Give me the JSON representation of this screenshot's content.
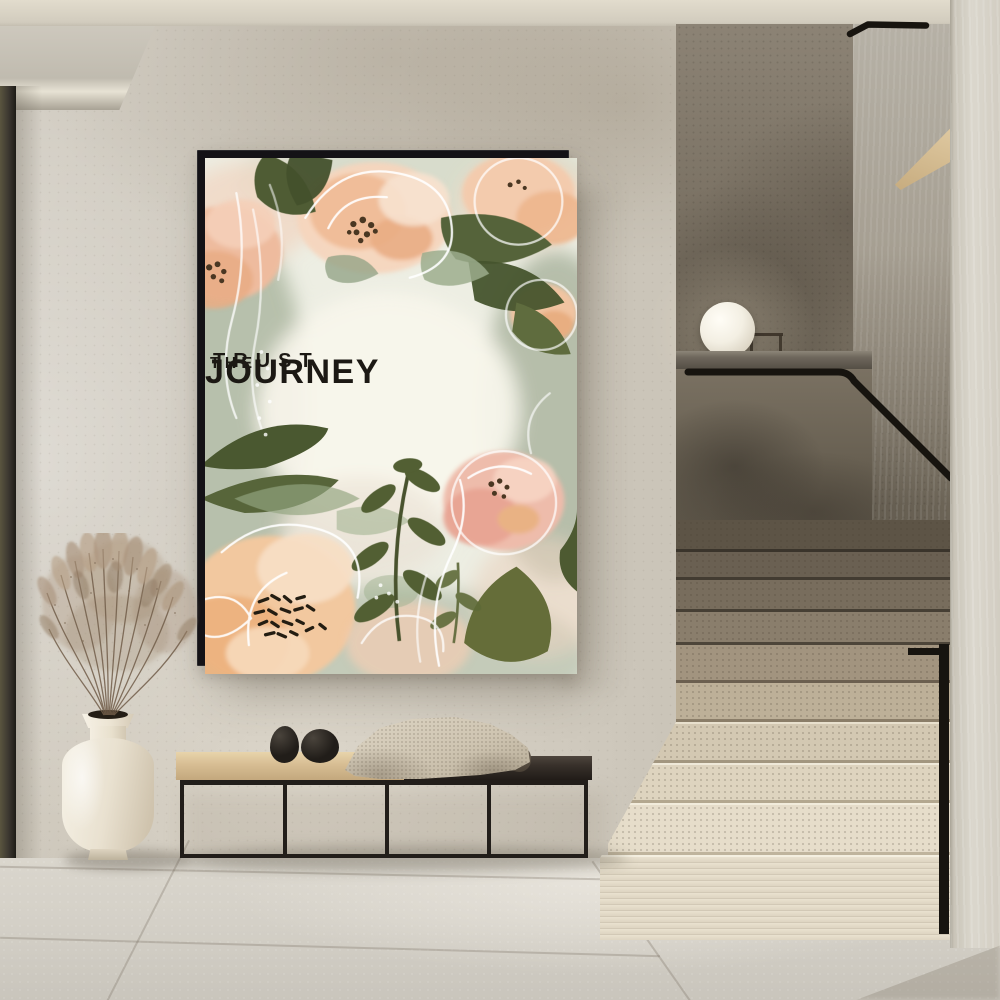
{
  "poster": {
    "line1": "TRUST",
    "line2": "THE",
    "line3": "JOURNEY"
  },
  "palette": {
    "ceiling": "#ded8ca",
    "wall": "#cbc5b9",
    "door": "#3b3730",
    "dark-wall": "#6f6759",
    "niche": "#b6b1a6",
    "wood-wedge": "#e0caa2",
    "ledge": "#6e675c",
    "glass": "#7a7162",
    "rail": "#17140f",
    "step-light": "#e6ddca",
    "step-shadow": "#6a6052",
    "pillar": "#dbd7cd",
    "floor": "#d4d0c7",
    "frame": "#141216",
    "art-bg": "#edeee3",
    "ink": "#1c1914",
    "peach": "#f2c89f",
    "peach-deep": "#e8ae81",
    "pink": "#eebcab",
    "green-dark": "#4a5830",
    "sage": "#9cad8d",
    "wood": "#d7bd93",
    "wood-dark": "#37302a",
    "metal": "#221e1a",
    "throw": "#cfc5b2",
    "pebble": "#211d19",
    "vase": "#e9e1d0",
    "pampas": "#a8917a",
    "lamp": "#f3efe3"
  }
}
